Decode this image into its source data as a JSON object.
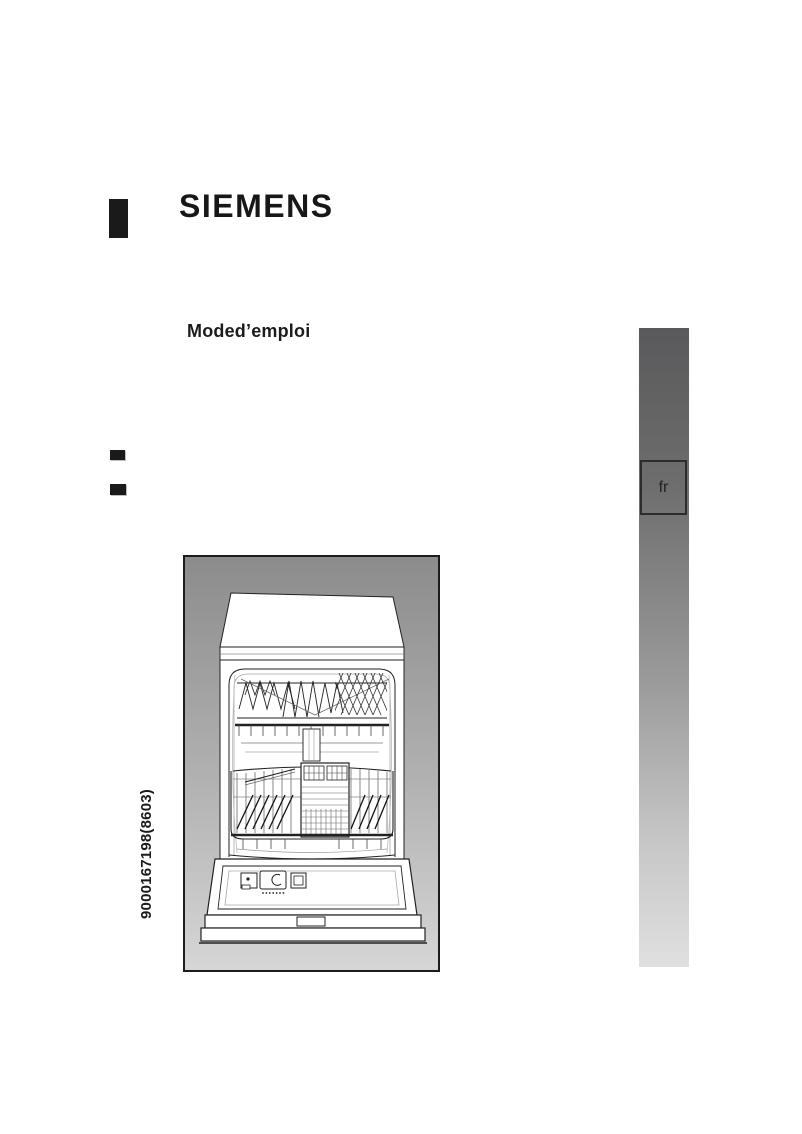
{
  "document": {
    "brand": "SIEMENS",
    "title": "Moded’emploi",
    "doc_number": "9000167198(8603)",
    "language_tab": "fr"
  },
  "figure": {
    "content": "dishwasher-line-drawing-open-door-with-baskets"
  },
  "colors": {
    "text": "#1a1a1a",
    "figure_frame_border": "#1c1c1c",
    "figure_gradient_top": "#8c8c8c",
    "figure_gradient_bottom": "#d6d6d6",
    "sidebar_gradient_top": "#59595b",
    "sidebar_gradient_bottom": "#e0e0e0"
  }
}
